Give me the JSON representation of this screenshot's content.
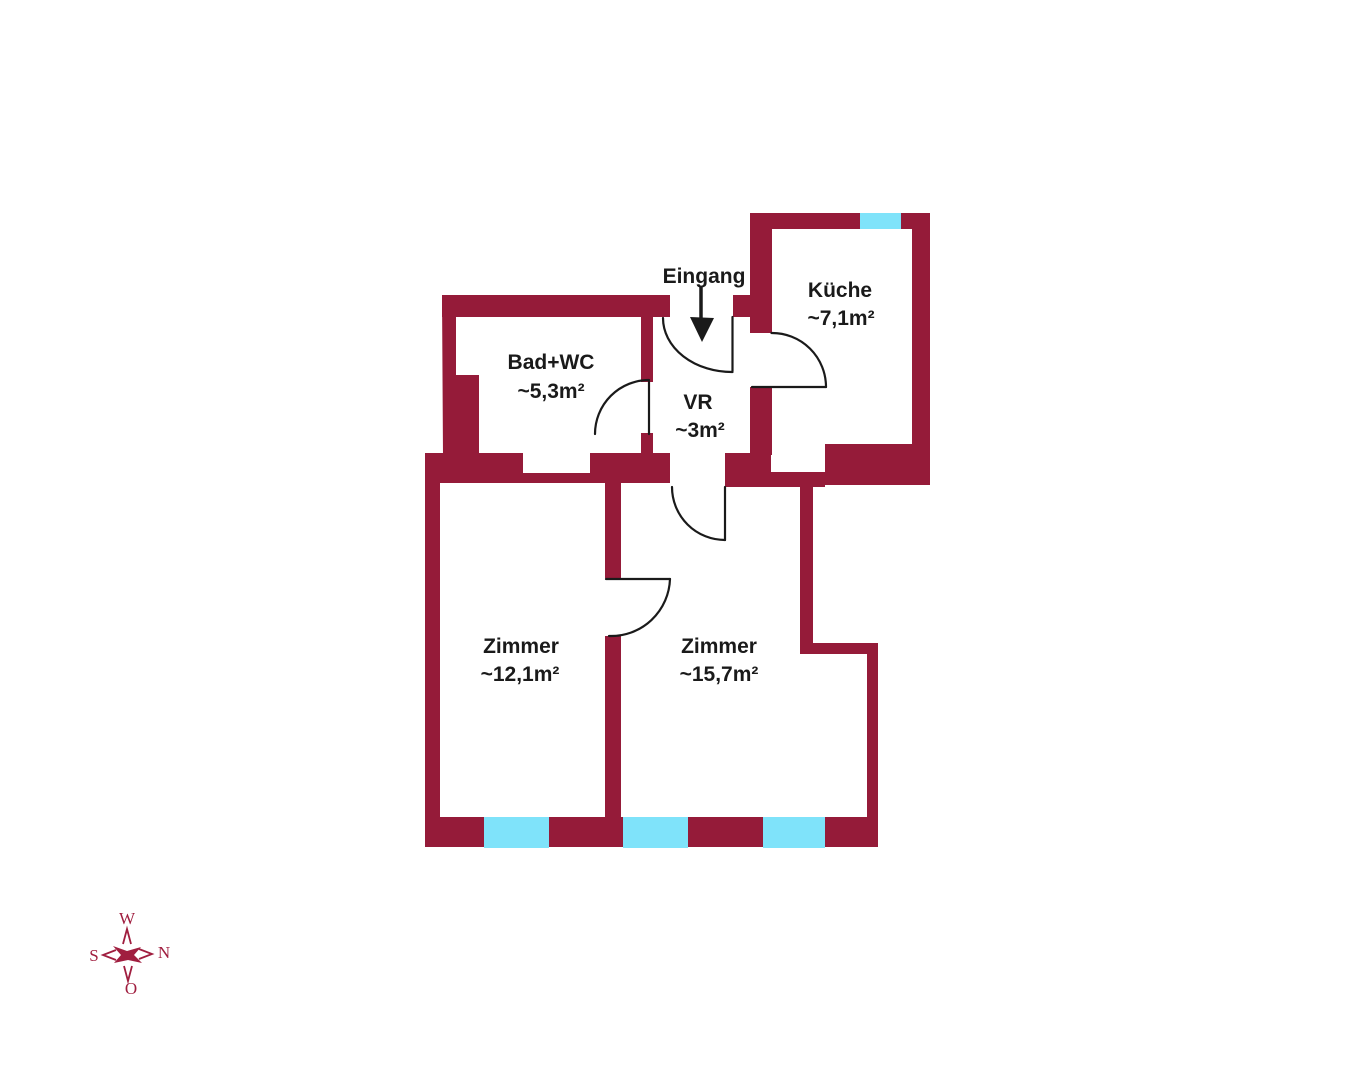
{
  "colors": {
    "wall": "#951B39",
    "window": "#7FE3FA",
    "line": "#1A1A1A",
    "compass": "#A01E3F"
  },
  "entrance": {
    "label": "Eingang"
  },
  "rooms": {
    "kueche": {
      "name": "Küche",
      "area": "~7,1m²"
    },
    "bad_wc": {
      "name": "Bad+WC",
      "area": "~5,3m²"
    },
    "vr": {
      "name": "VR",
      "area": "~3m²"
    },
    "zimmer_west": {
      "name": "Zimmer",
      "area": "~12,1m²"
    },
    "zimmer_ost": {
      "name": "Zimmer",
      "area": "~15,7m²"
    }
  },
  "compass": {
    "top": "W",
    "right": "N",
    "left": "S",
    "bottom": "O"
  }
}
